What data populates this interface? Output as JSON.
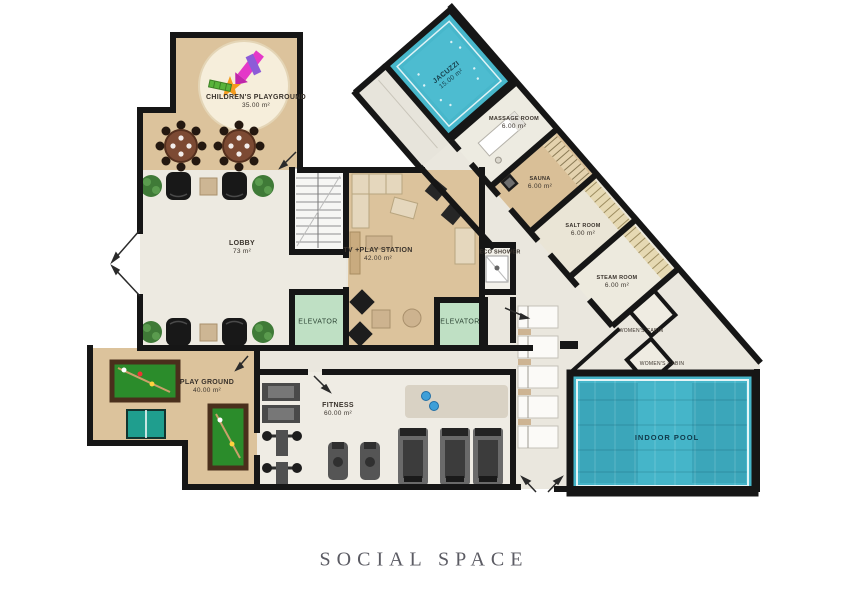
{
  "caption": "SOCIAL SPACE",
  "rooms": {
    "childrens_playground": {
      "name": "CHILDREN'S PLAYGROUND",
      "area": "35.00 m²"
    },
    "lobby": {
      "name": "LOBBY",
      "area": "73 m²"
    },
    "tv_play_station": {
      "name": "TV +PLAY STATION",
      "area": "42.00 m²"
    },
    "elevator_left": {
      "name": "ELEVATOR"
    },
    "elevator_right": {
      "name": "ELEVATOR"
    },
    "eco_shower": {
      "name": "ECO SHOWER"
    },
    "jacuzzi": {
      "name": "JACUZZI",
      "area": "15.00 m²"
    },
    "massage_room": {
      "name": "MASSAGE ROOM",
      "area": "6.00 m²"
    },
    "sauna": {
      "name": "SAUNA",
      "area": "6.00 m²"
    },
    "salt_room": {
      "name": "SALT ROOM",
      "area": "6.00 m²"
    },
    "steam_room": {
      "name": "STEAM ROOM",
      "area": "6.00 m²"
    },
    "womens_cabin_upper": {
      "name": "WOMEN'S CABIN"
    },
    "womens_cabin_lower": {
      "name": "WOMEN'S CABIN"
    },
    "play_ground": {
      "name": "PLAY GROUND",
      "area": "40.00 m²"
    },
    "fitness": {
      "name": "FITNESS",
      "area": "60.00 m²"
    },
    "indoor_pool": {
      "name": "INDOOR POOL"
    }
  },
  "colors": {
    "wall": "#161616",
    "floor": "#eae7de",
    "wood": "#dcc39c",
    "water": "#47b7cb",
    "elevator": "#bfe0c4",
    "billiard_felt": "#2b8c2b",
    "caption_text": "#5b5b63"
  }
}
